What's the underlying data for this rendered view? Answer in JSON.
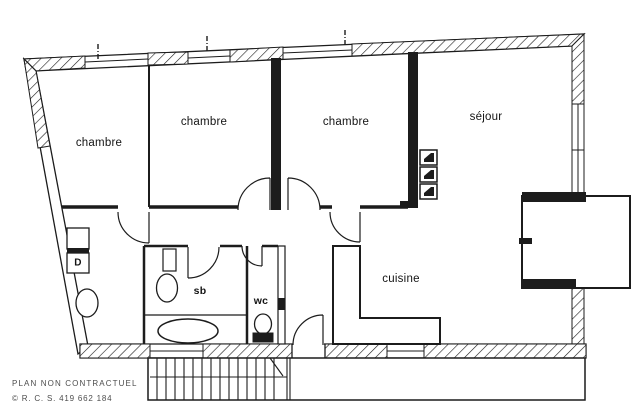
{
  "window": {
    "width": 640,
    "height": 415,
    "background": "#ffffff"
  },
  "plan": {
    "ink_color": "#1c1c1c",
    "label_color": "#141414",
    "rooms": [
      {
        "id": "bedroom-1",
        "label": "chambre"
      },
      {
        "id": "bedroom-2",
        "label": "chambre"
      },
      {
        "id": "bedroom-3",
        "label": "chambre"
      },
      {
        "id": "living-room",
        "label": "séjour"
      },
      {
        "id": "kitchen",
        "label": "cuisine"
      },
      {
        "id": "bathroom",
        "label": "sb"
      },
      {
        "id": "toilet",
        "label": "wc"
      },
      {
        "id": "closet",
        "label": "D"
      }
    ]
  },
  "footer": {
    "disclaimer": "PLAN NON CONTRACTUEL",
    "registration": "© R. C. S. 419 662 184",
    "text_color": "#4d4d4d"
  }
}
